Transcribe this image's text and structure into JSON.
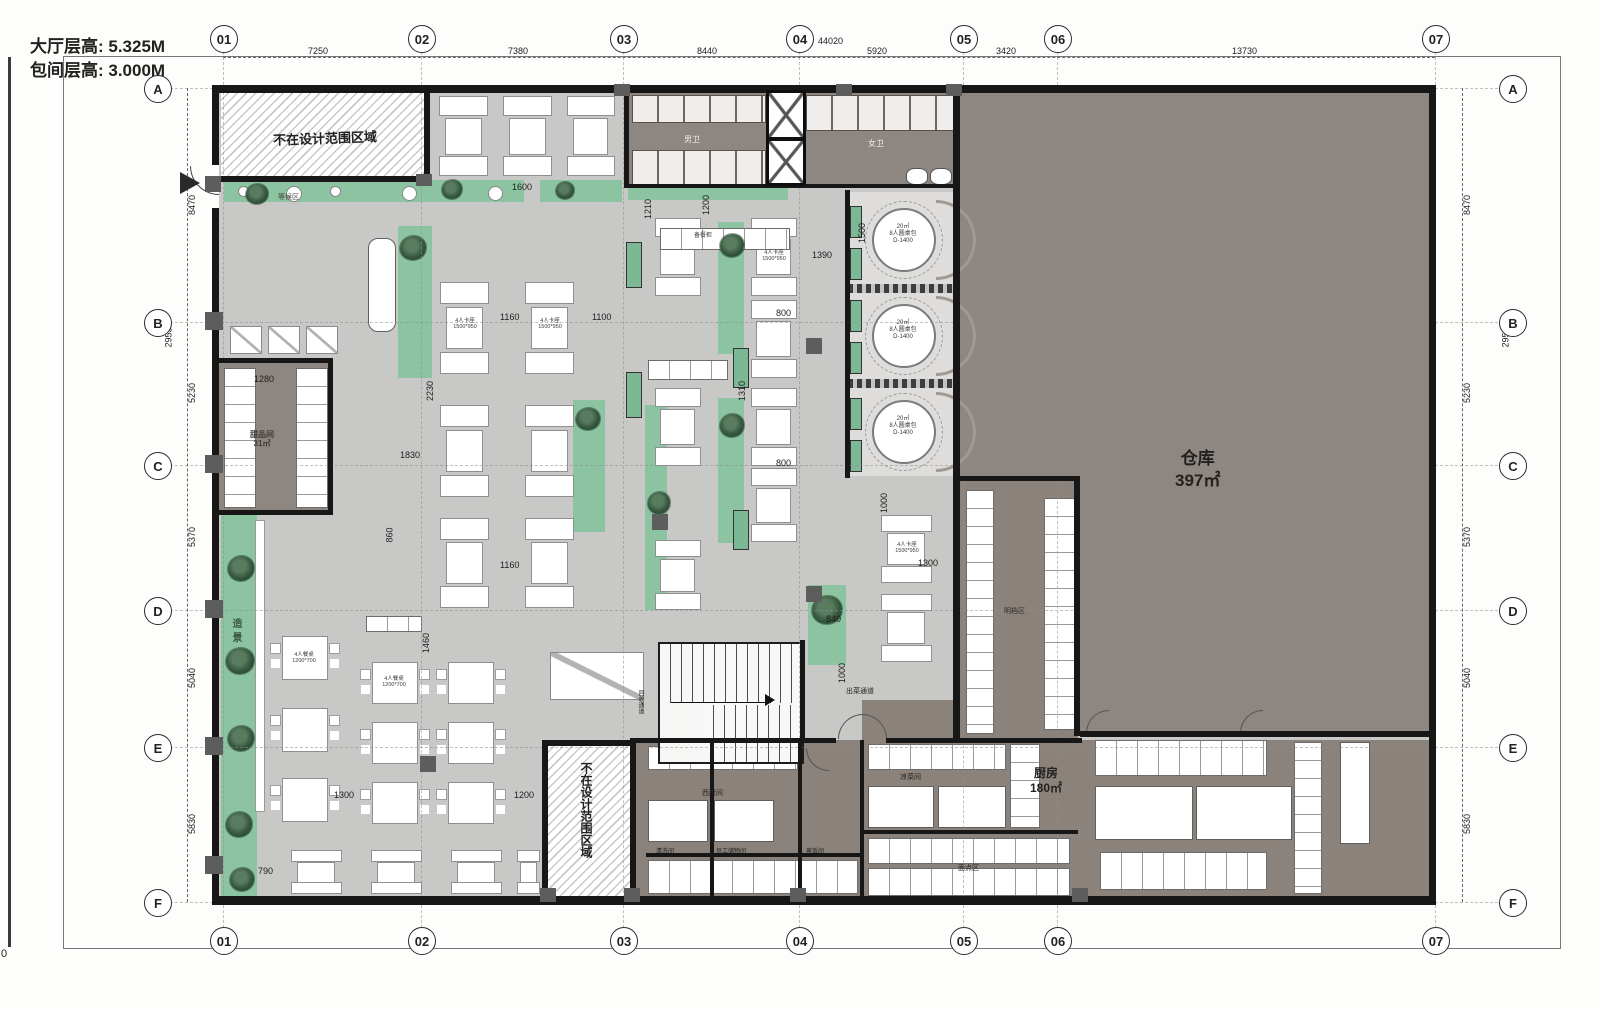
{
  "title_block": {
    "line1": "大厅层高: 5.325M",
    "line2": "包间层高: 3.000M",
    "corner_mark": "0"
  },
  "grid": {
    "cols": [
      "01",
      "02",
      "03",
      "04",
      "05",
      "06",
      "07"
    ],
    "rows": [
      "A",
      "B",
      "C",
      "D",
      "E",
      "F"
    ]
  },
  "dimensions": {
    "top": [
      "7250",
      "7380",
      "8440",
      "5920",
      "3420",
      "13730"
    ],
    "top_total": "44020",
    "side": [
      "8470",
      "5230",
      "5370",
      "5040",
      "5830"
    ],
    "side_total": "29530",
    "interior": [
      "1600",
      "1200",
      "1210",
      "1390",
      "1500",
      "1160",
      "1100",
      "800",
      "2230",
      "1310",
      "800",
      "1280",
      "1830",
      "860",
      "1160",
      "1300",
      "840",
      "1000",
      "1000",
      "1460",
      "1300",
      "790",
      "1200"
    ]
  },
  "rooms": {
    "out_of_scope": "不在设计范围区域",
    "warehouse_name": "仓库",
    "warehouse_area": "397㎡",
    "kitchen_name": "厨房",
    "kitchen_area": "180㎡",
    "male_wc": "男卫",
    "female_wc": "女卫",
    "waiting": "等候区",
    "dessert_name": "甜品间",
    "dessert_area": "31㎡",
    "landscape": "造景",
    "open_counter": "明档区",
    "dish_corridor": "出菜通道",
    "recycle_corridor": "回收通道",
    "west_kitchen": "西厨间",
    "wash_room": "清洗间",
    "staff_storage": "员工储物间",
    "rice_room": "蒸饭间",
    "cold_dish": "凉菜间",
    "pastry": "面点区"
  },
  "furniture": {
    "private_l1": "20㎡",
    "private_l2": "8人圆桌包",
    "private_l3": "D-1400",
    "booth_l1": "4人卡座",
    "booth_l2": "1500*950",
    "table_l1": "4人餐桌",
    "table_l2": "1200*700",
    "counter_label": "备餐柜"
  },
  "colors": {
    "hall_floor": "#c8c8c6",
    "service_floor": "#8e8680",
    "wall": "#171717",
    "planting": "#8cc3a0"
  }
}
